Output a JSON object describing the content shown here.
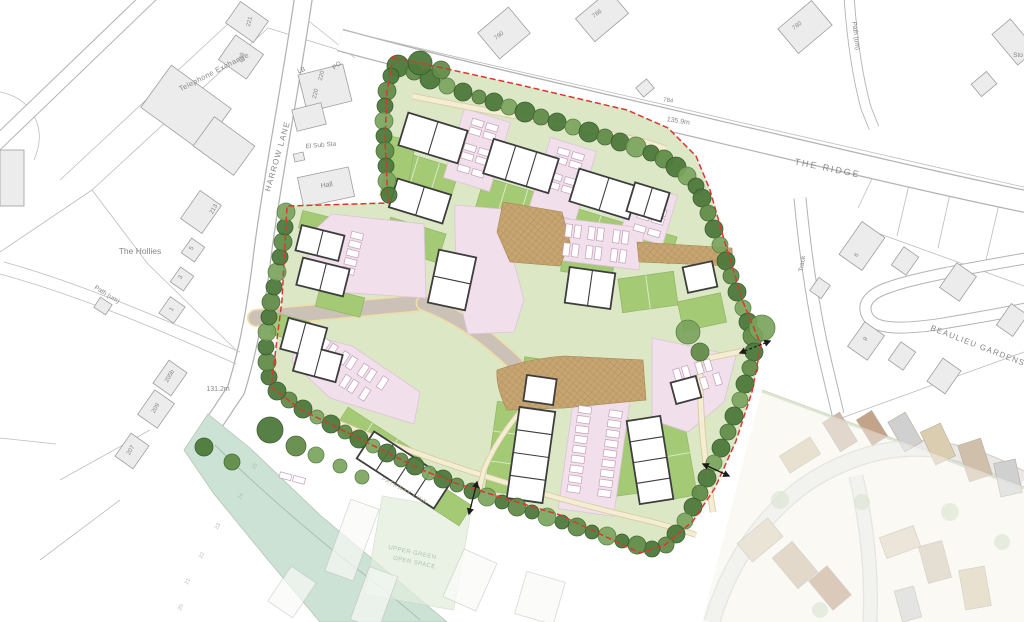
{
  "colors": {
    "site_green": "#dbe7c5",
    "garden_green": "#a5ca76",
    "tree_green": "#4e7a3c",
    "parking_pink": "#f1dfec",
    "road_grey": "#ccc1b7",
    "paving_tan": "#c7a572",
    "path_cream": "#f4edd3",
    "boundary_red": "#d83832",
    "base_building_grey": "#ececec",
    "watercourse_green": "#cbe2d4"
  },
  "map": {
    "streets": {
      "harrow_lane": "HARROW LANE",
      "the_ridge": "THE RIDGE",
      "beaulieu_gardens": "BEAULIEU  GARDENS",
      "track": "Track",
      "path_um_north": "Path (um)",
      "path_um_west": "Path (um)"
    },
    "places": {
      "telephone_exchange": "Telephone Exchange",
      "the_hollies": "The Hollies",
      "el_sub_sta": "El Sub Sta",
      "hall": "Hall",
      "lb": "LB",
      "po": "PO",
      "sto": "Sto"
    },
    "spot_heights": {
      "west": "131.2m",
      "north": "135.9m"
    },
    "house_numbers": {
      "n221": "221",
      "n219": "219",
      "n220a": "220",
      "n220b": "220",
      "n790": "790",
      "n786": "786",
      "n784": "784",
      "n780": "780",
      "n213": "213",
      "n205b": "205b",
      "n209": "209",
      "n207": "207",
      "n6": "6",
      "n9": "9",
      "n5": "5",
      "n3": "3",
      "n1": "1"
    },
    "adjacent_plot_numbers": {
      "p25": "25",
      "p24": "24",
      "p23": "23",
      "p22": "22",
      "p21": "21",
      "p20": "20"
    },
    "annotations": {
      "upper_green_line1": "UPPER GREEN",
      "upper_green_line2": "OPEN SPACE",
      "pathway_link": "PATHWAY LINK"
    }
  }
}
